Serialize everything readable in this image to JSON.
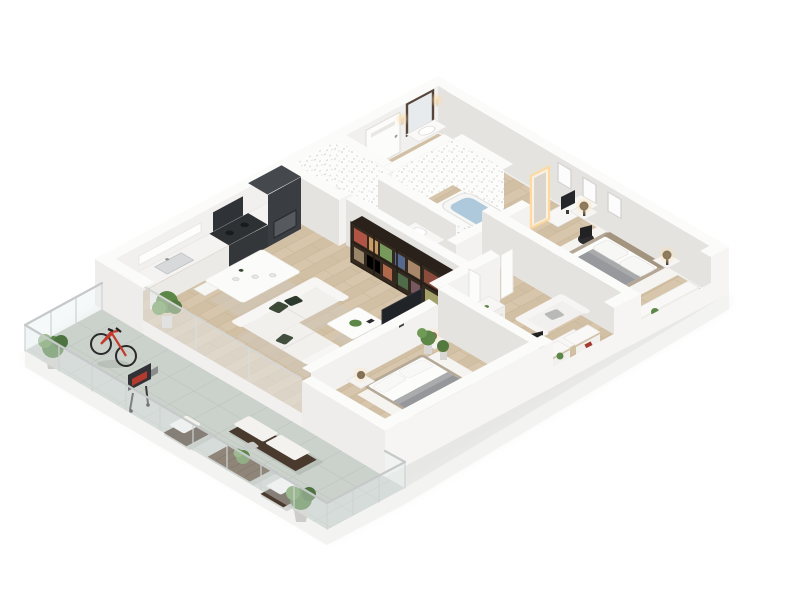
{
  "scene": {
    "title": "3D apartment floor plan render",
    "style": "isometric cutaway, white background",
    "floor_material": "light oak plank",
    "terrace_material": "grey tile"
  },
  "palette": {
    "background": "#ffffff",
    "wall": "#f1f0ee",
    "wall_shade": "#e5e3e0",
    "wood_floor": "#d7c6ac",
    "terrace_tile": "#cbd1cb",
    "dark_units": "#34373a",
    "bookshelf": "#33291f",
    "sofa_white": "#f2f1ee",
    "cushion_green": "#3d4a38",
    "duvet_gray": "#97999c",
    "bed_frame_taupe": "#b5a795",
    "bath_water": "#aec9dc",
    "bicycle_red": "#c23b2e",
    "plant_green": "#5d8748",
    "lamp_glow": "#ffd79e",
    "outdoor_wood": "#4a3a2e"
  },
  "rooms": {
    "terrace": {
      "label": "Terrace",
      "items": [
        "glass railing",
        "red bicycle",
        "barbecue grill",
        "outdoor sofa",
        "two outdoor armchairs",
        "slatted wood coffee table",
        "potted plants",
        "tiled floor"
      ]
    },
    "kitchen": {
      "label": "Kitchen",
      "items": [
        "white counter run",
        "dark tall oven cabinet",
        "dark cooktop counter",
        "extractor hood",
        "sink",
        "wall shelf"
      ]
    },
    "dining": {
      "label": "Dining area",
      "items": [
        "white dining table",
        "six white chairs",
        "tableware"
      ]
    },
    "living": {
      "label": "Living room",
      "items": [
        "white L-shaped sofa",
        "dark green cushions",
        "white coffee table with plant",
        "dark bookshelf partition",
        "TV on half wall",
        "palm plant"
      ]
    },
    "shower_room": {
      "label": "Shower room",
      "items": [
        "speckled tile walls",
        "shower tray"
      ]
    },
    "entry": {
      "label": "Entry hall",
      "items": [
        "front door",
        "wood framed mirror",
        "two wall sconces",
        "washbasin console",
        "potted plant"
      ]
    },
    "bathroom": {
      "label": "Bathroom",
      "items": [
        "bathtub with water",
        "speckled tile walls",
        "half wall",
        "vanity basin"
      ]
    },
    "dressing": {
      "label": "Desk nook",
      "items": [
        "white desk",
        "monitor",
        "black office chair",
        "illuminated mirror"
      ]
    },
    "master_bedroom": {
      "label": "Master bedroom",
      "items": [
        "double bed",
        "grey duvet",
        "two nightstands",
        "two dark table lamps",
        "three wall frames",
        "white rug",
        "window bench with plant and book"
      ]
    },
    "second_bedroom": {
      "label": "Second bedroom",
      "items": [
        "double bed",
        "grey duvet",
        "two nightstands with lamps",
        "white rug",
        "corner plants"
      ]
    },
    "office": {
      "label": "Guest room / office",
      "items": [
        "white dresser",
        "white loveseat",
        "desk",
        "black office chair",
        "window sills with plants"
      ]
    }
  }
}
